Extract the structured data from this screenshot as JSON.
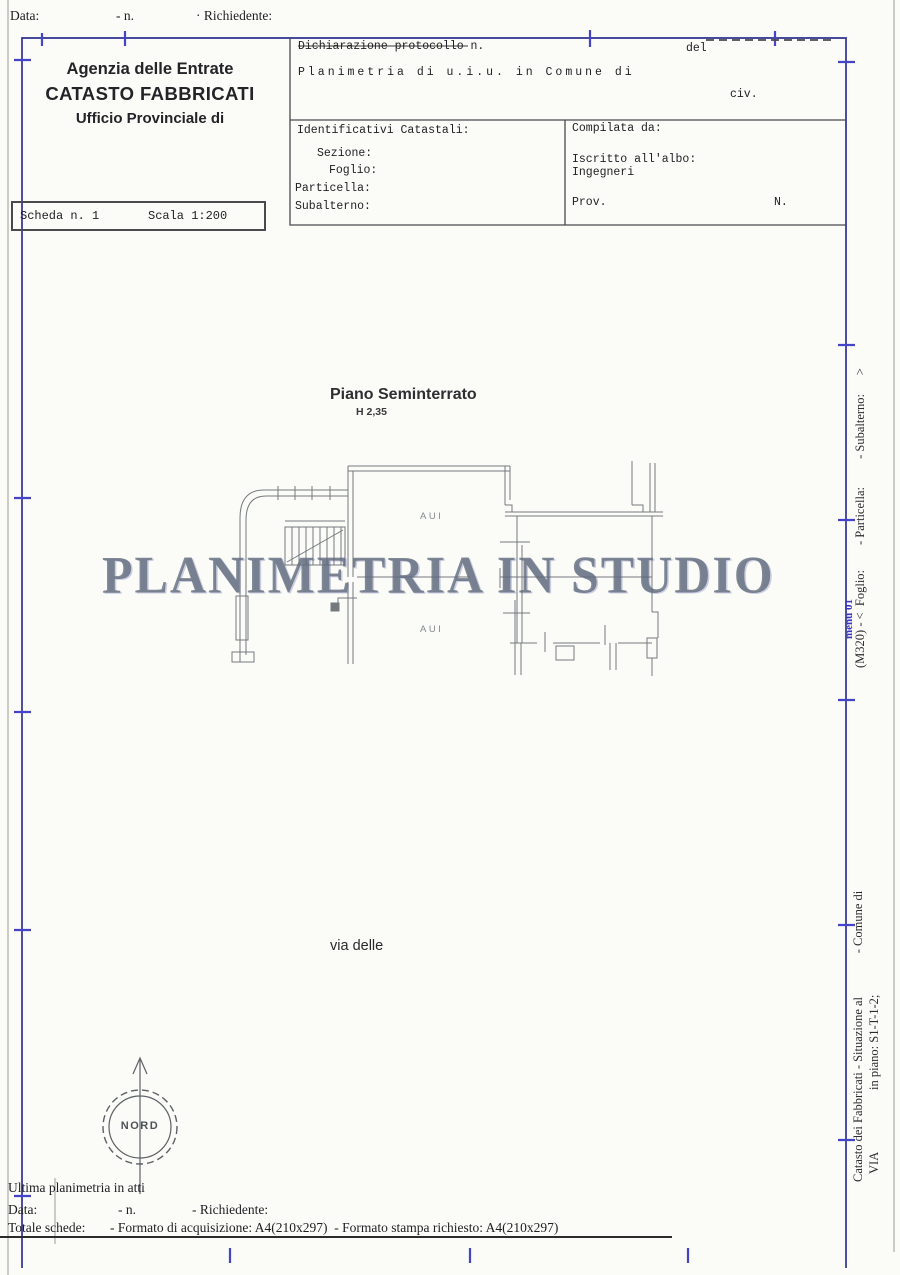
{
  "page": {
    "frame_color": "#2e3192",
    "tick_color": "#4543c8",
    "line_color": "#4a4a4e",
    "plan_color": "#74797e",
    "watermark_color": "#626b7c"
  },
  "top_bar": {
    "data_label": "Data:",
    "n_label": "- n.",
    "richiedente_label": "· Richiedente:"
  },
  "agency": {
    "line1": "Agenzia delle Entrate",
    "line2": "CATASTO FABBRICATI",
    "line3": "Ufficio Provinciale di"
  },
  "protocol": {
    "dichiarazione": "Dichiarazione protocollo n.",
    "del": "del",
    "planimetria": "Planimetria di u.i.u. in Comune di",
    "civ": "civ."
  },
  "identificativi": {
    "title": "Identificativi Catastali:",
    "sezione": "Sezione:",
    "foglio": "Foglio:",
    "particella": "Particella:",
    "subalterno": "Subalterno:"
  },
  "compilata": {
    "title": "Compilata da:",
    "iscritto": "Iscritto all'albo:",
    "albo": "Ingegneri",
    "prov": "Prov.",
    "n": "N."
  },
  "scheda": {
    "scheda_label": "Scheda n. 1",
    "scala_label": "Scala 1:200"
  },
  "plan": {
    "title": "Piano Seminterrato",
    "height_label": "H 2,35",
    "room_labels": [
      "AUI",
      "AUI"
    ],
    "street": "via delle",
    "compass": "NORD"
  },
  "watermark": {
    "text": "PLANIMETRIA IN STUDIO"
  },
  "sidebar": {
    "upper": "(M320) - <  Foglio:        - Particella:         - Subalterno:      >",
    "blue_note": "menu 01",
    "lower_line1": "Catasto dei Fabbricati - Situazione al              - Comune di",
    "lower_line2": "VIA                    in piano: S1-T-1-2;"
  },
  "footer": {
    "ultima": "Ultima planimetria in atti",
    "data_label": "Data:",
    "n_label": "- n.",
    "richiedente_label": "- Richiedente:",
    "totale_label": "Totale schede:",
    "formato": "- Formato di acquisizione: A4(210x297)  - Formato stampa richiesto: A4(210x297)"
  }
}
